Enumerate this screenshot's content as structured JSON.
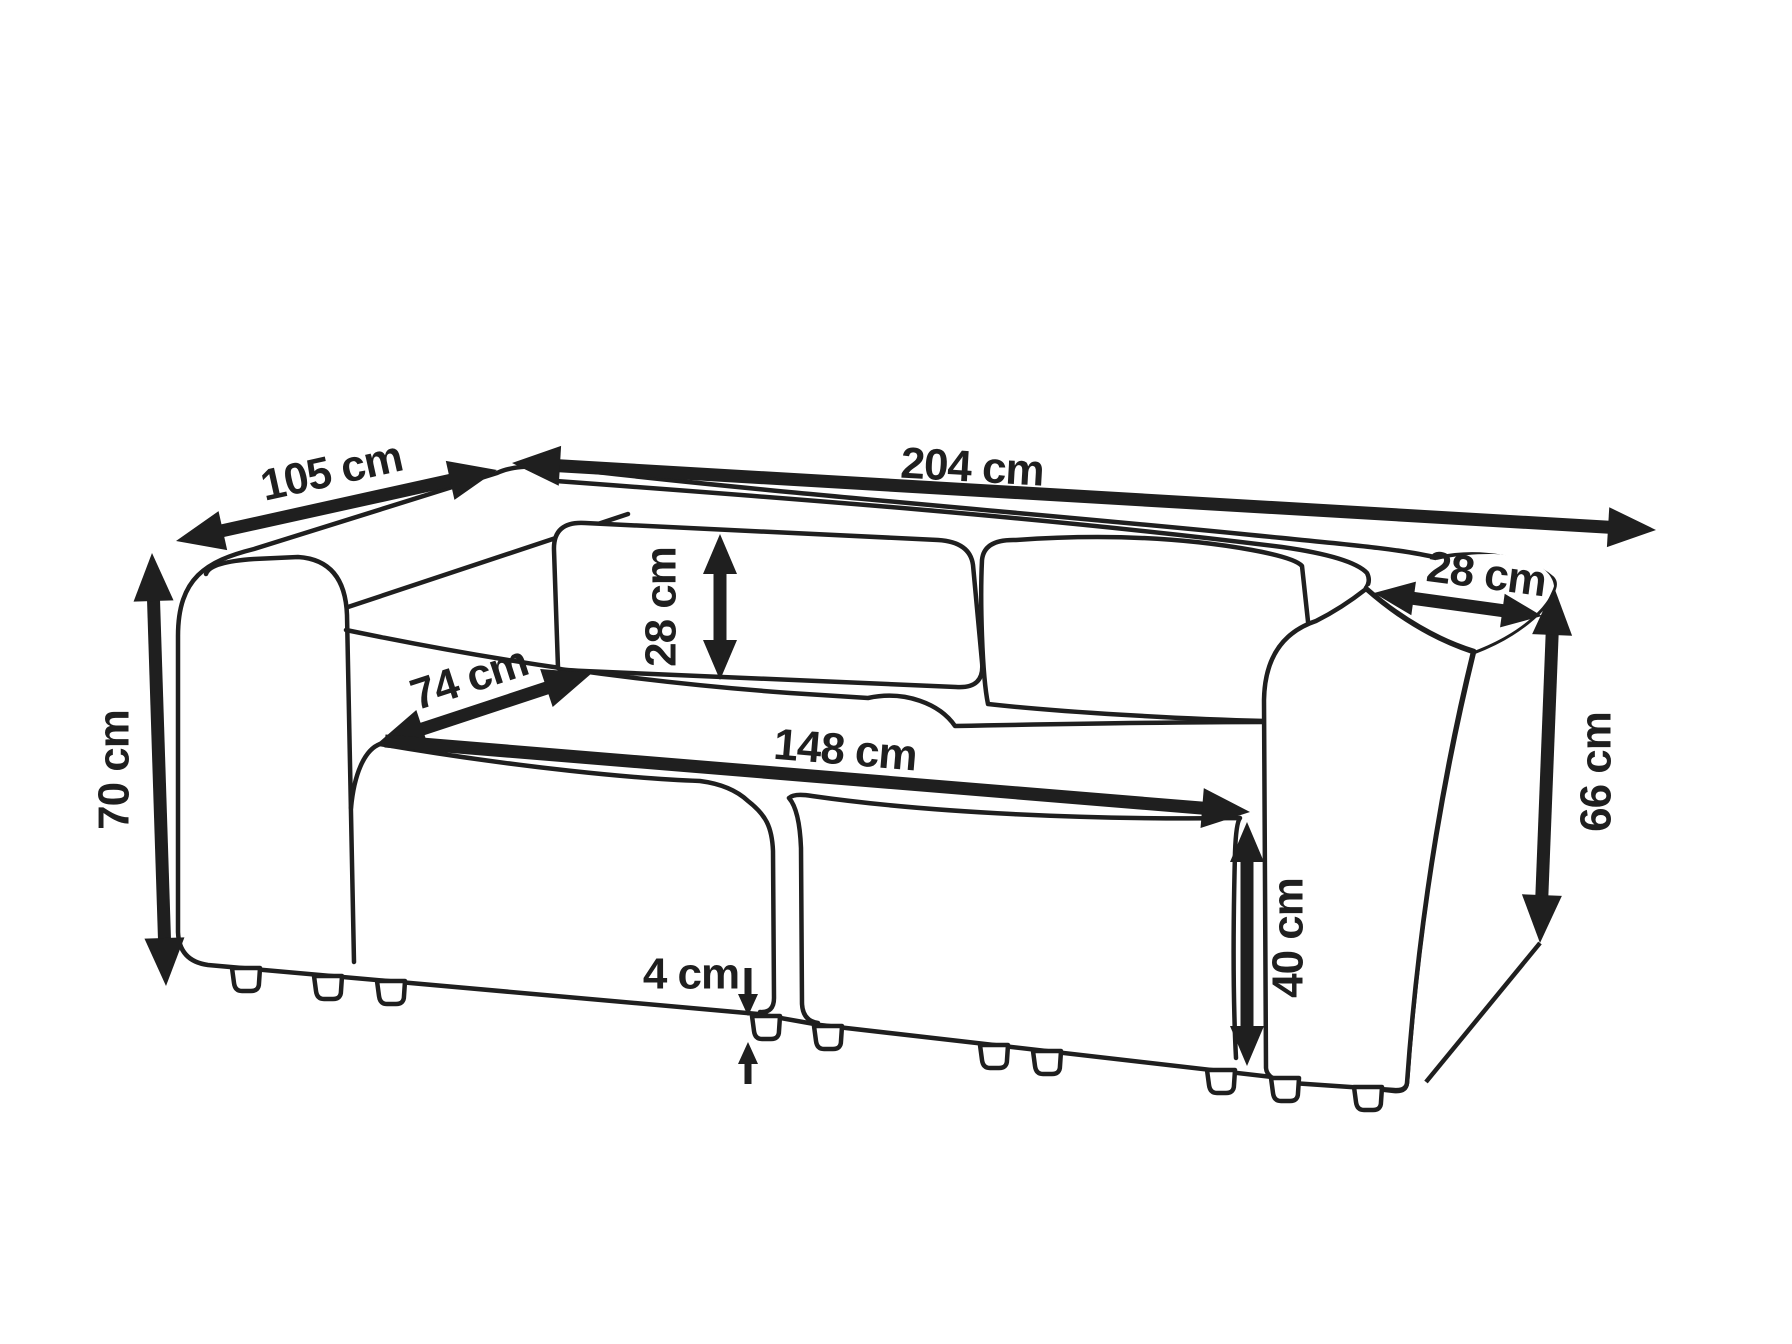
{
  "figure": {
    "type": "furniture dimension diagram",
    "subject": "two-seat modular sofa line drawing, three-quarter perspective view",
    "unit": "cm",
    "background_color": "#ffffff",
    "line_color": "#1f1f1f"
  },
  "dimensions": {
    "overall_depth": {
      "label": "105 cm",
      "value": 105
    },
    "overall_width": {
      "label": "204 cm",
      "value": 204
    },
    "backrest_height": {
      "label": "28 cm",
      "value": 28
    },
    "armrest_width": {
      "label": "28 cm",
      "value": 28
    },
    "seat_depth": {
      "label": "74 cm",
      "value": 74
    },
    "seat_width": {
      "label": "148 cm",
      "value": 148
    },
    "overall_height": {
      "label": "70 cm",
      "value": 70
    },
    "armrest_height": {
      "label": "66 cm",
      "value": 66
    },
    "seat_height": {
      "label": "40 cm",
      "value": 40
    },
    "leg_height": {
      "label": "4 cm",
      "value": 4
    }
  }
}
